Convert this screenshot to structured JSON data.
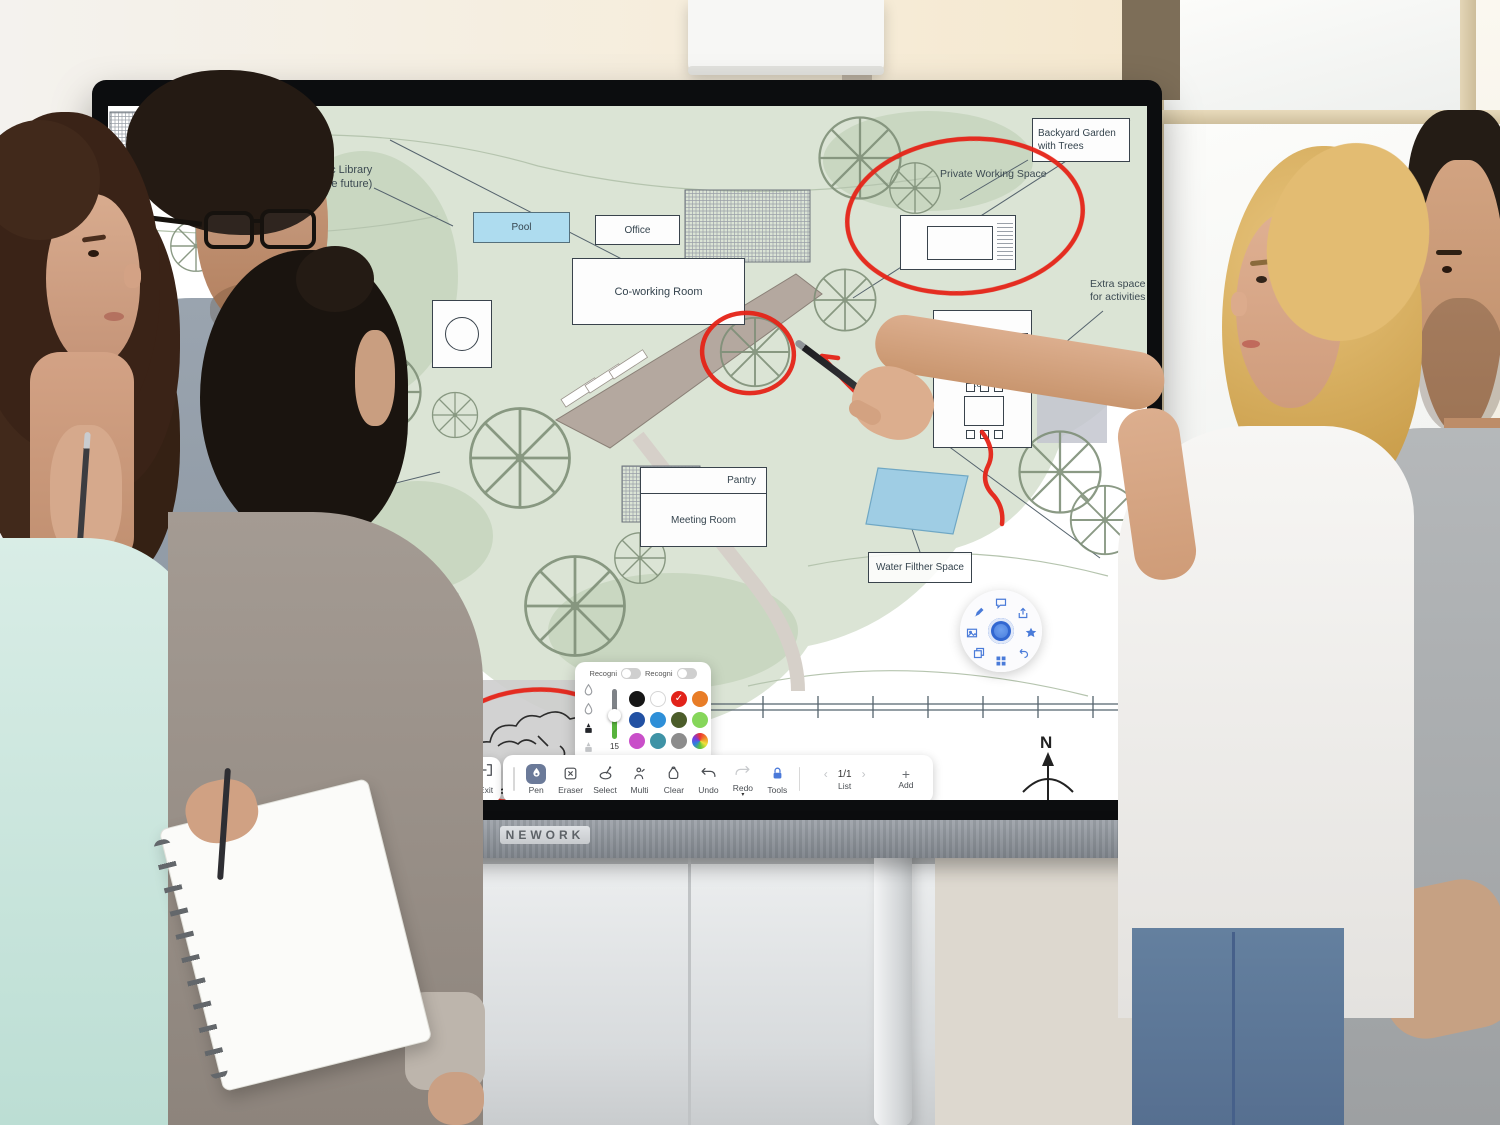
{
  "device": {
    "brand_logo": "NEWORK"
  },
  "colors": {
    "annotation_red": "#e52318",
    "accent_blue": "#4a7bd9",
    "toolbar_active": "#6b7a99",
    "garden_green": "#dbe4d5",
    "pool_blue": "#aedcef"
  },
  "plan": {
    "labels": {
      "backyard": "Backyard Garden with Trees",
      "private": "Private Working Space",
      "pool": "Pool",
      "office": "Office",
      "coworking": "Co-working Room",
      "living": "Living & Dining Room",
      "pantry": "Pantry",
      "meeting": "Meeting Room",
      "water": "Water Filther Space",
      "library_line1": "ublic Library",
      "library_line2": "n the future)",
      "corridor_line1": "en coridor",
      "corridor_line2": "to space",
      "bathroom": "Bathroom & Toilet",
      "extra_line1": "Extra space",
      "extra_line2": "for activities",
      "compass_n": "N"
    }
  },
  "pen_popup": {
    "toggle1_label": "Recogni",
    "toggle2_label": "Recogni",
    "size_value": "15",
    "selected_color_index": 2,
    "pen_types": [
      "pen-drop",
      "brush-drop",
      "ink-bottle-dark",
      "ink-bottle-light"
    ],
    "colors": [
      "#161616",
      "#ffffff",
      "#e2231a",
      "#e87d27",
      "#2251a3",
      "#2e8fd8",
      "#4c5d2a",
      "#86d65a",
      "#c94fc9",
      "#3f93a6",
      "#8c8c8c",
      "rainbow"
    ],
    "check_glyph": "✓"
  },
  "toolbar": {
    "items": [
      {
        "icon": "pen-nib",
        "label": "Pen",
        "active": true
      },
      {
        "icon": "eraser",
        "label": "Eraser"
      },
      {
        "icon": "lasso-select",
        "label": "Select"
      },
      {
        "icon": "multi-touch",
        "label": "Multi"
      },
      {
        "icon": "clear-bag",
        "label": "Clear"
      },
      {
        "icon": "undo-arrow",
        "label": "Undo"
      },
      {
        "icon": "redo-arrow",
        "label": "Redo",
        "caret": "▾"
      },
      {
        "icon": "lock-tools",
        "label": "Tools"
      }
    ],
    "pager": {
      "prev": "‹",
      "page": "1/1",
      "next": "›",
      "label": "List"
    },
    "add": {
      "symbol": "+",
      "label": "Add"
    },
    "exit": {
      "label": "Exit",
      "partial_neighbor_label": "u"
    }
  },
  "widget": {
    "center": "gear",
    "icons": [
      "chat",
      "share",
      "star",
      "undo",
      "apps",
      "copy",
      "image",
      "pen"
    ]
  }
}
